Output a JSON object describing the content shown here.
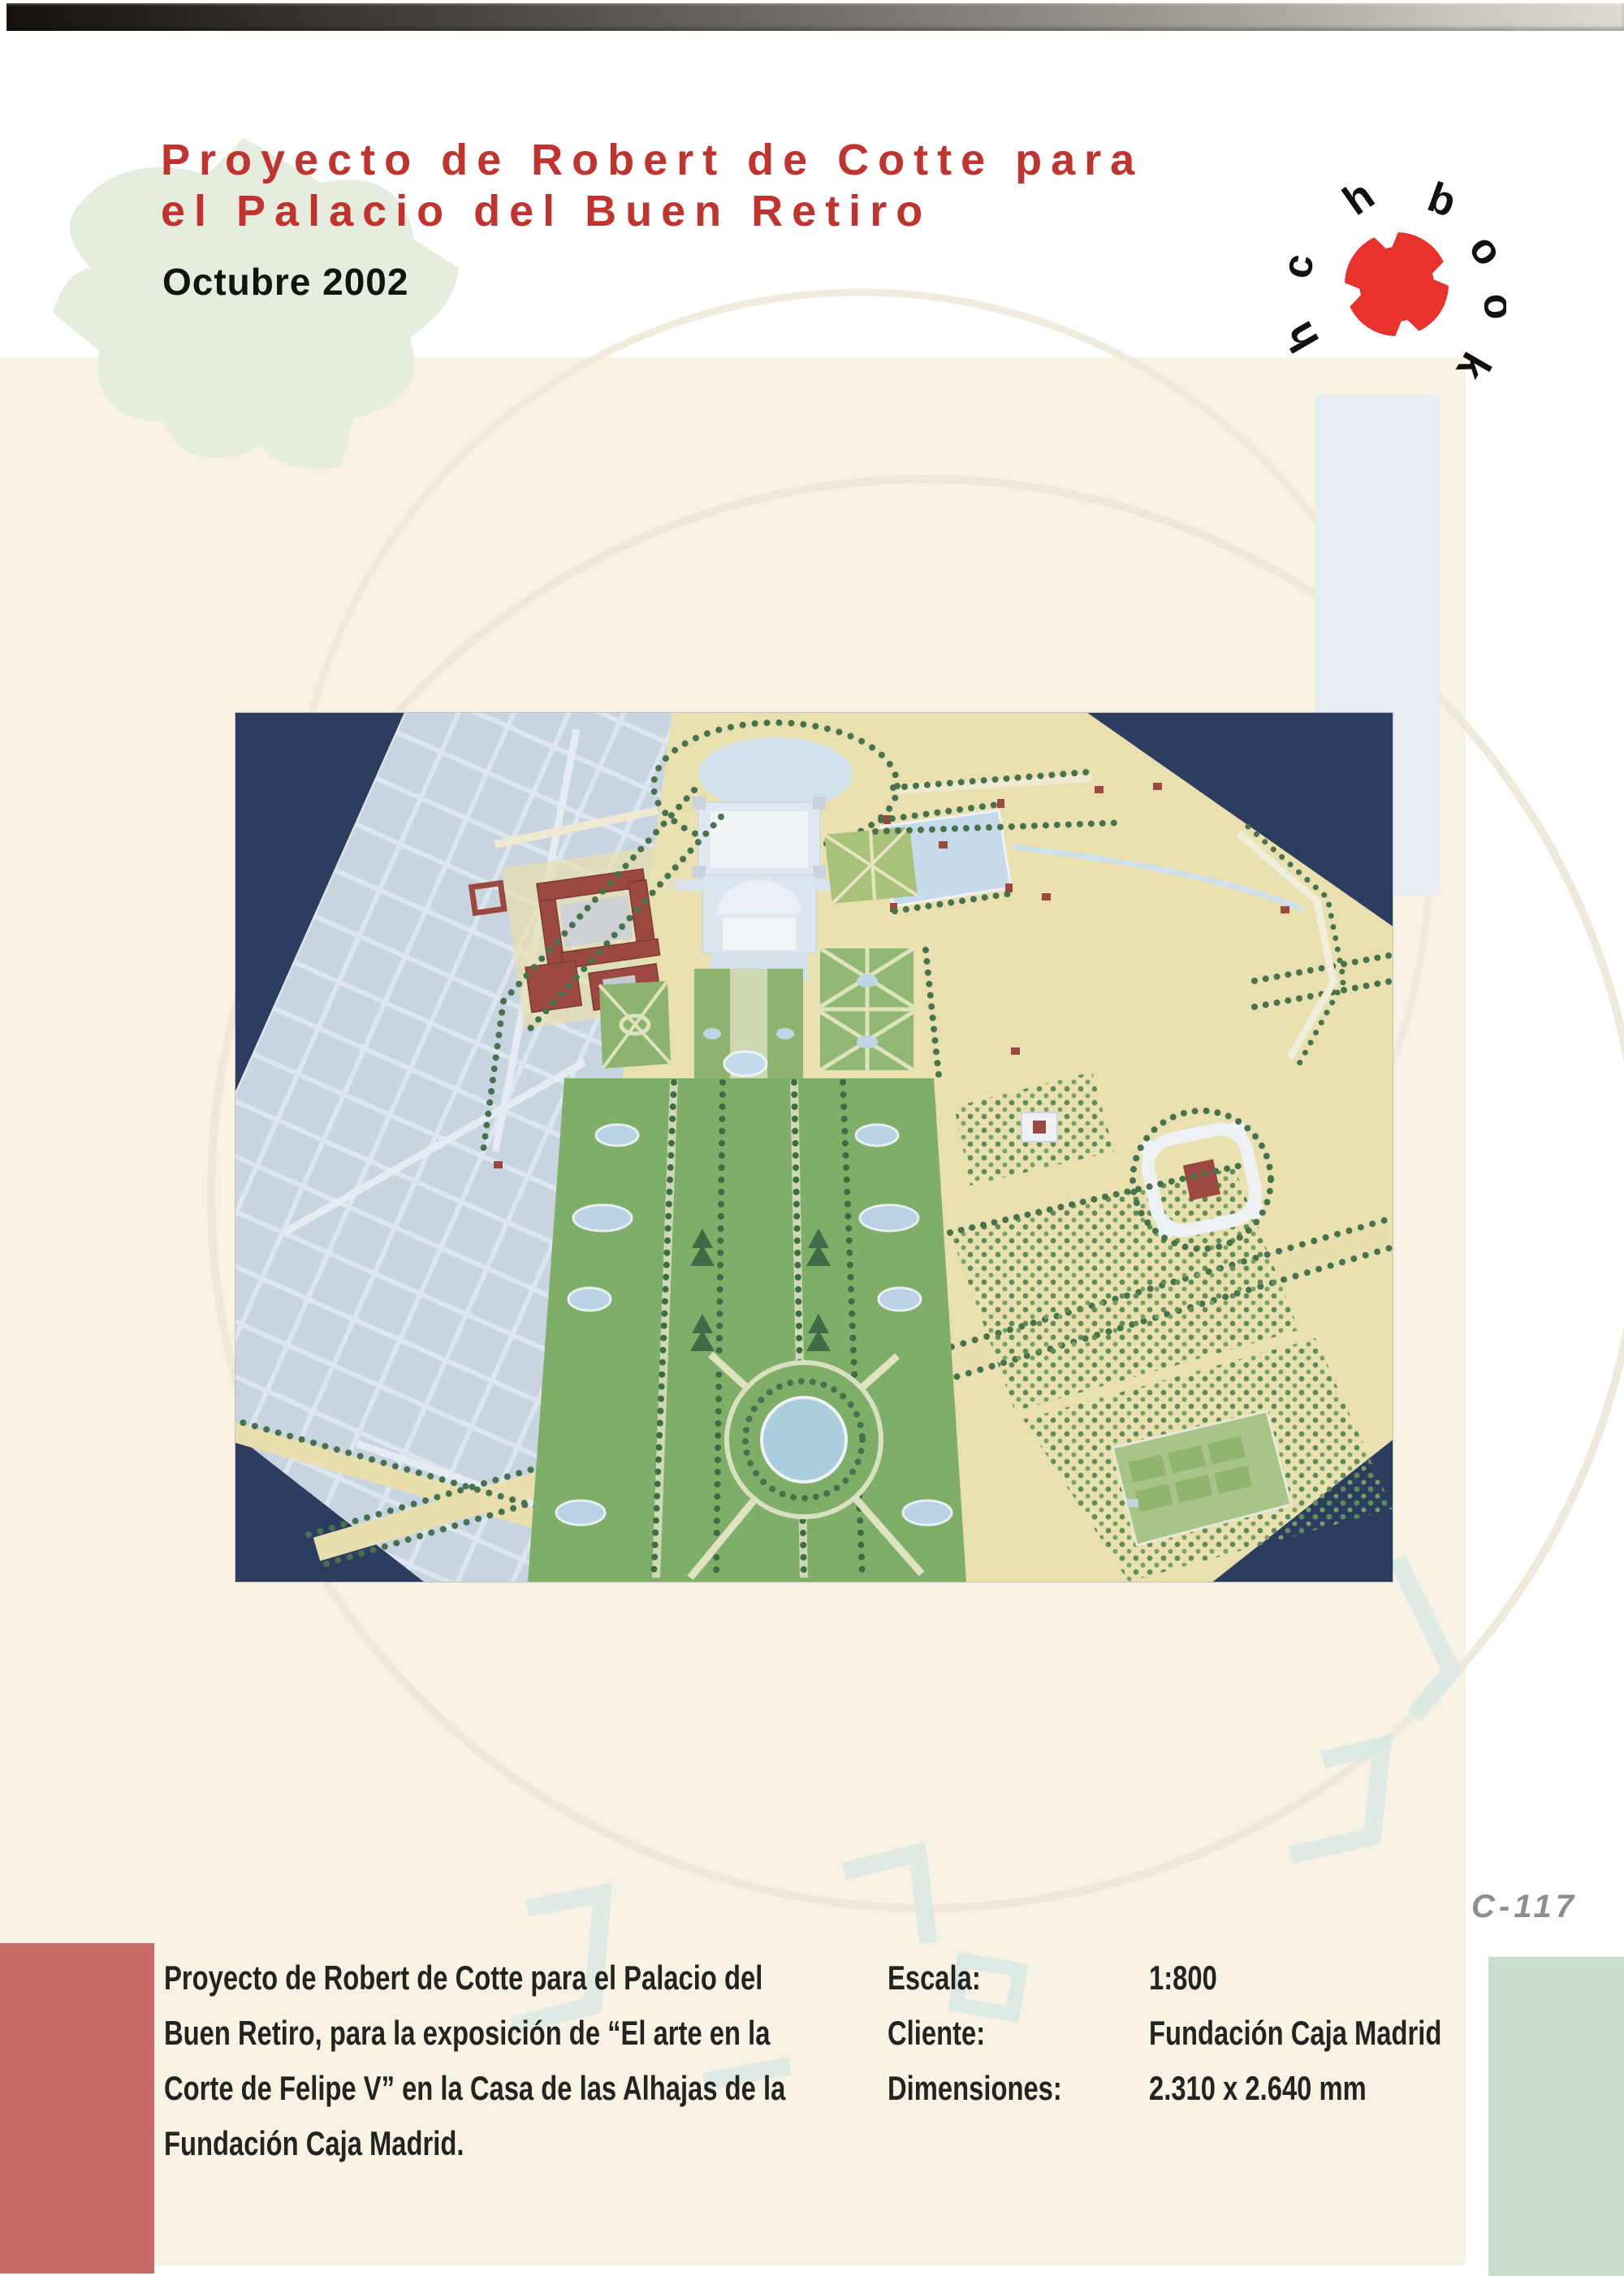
{
  "header": {
    "title_line1": "Proyecto de Robert de Cotte para",
    "title_line2": "el Palacio del Buen Retiro",
    "date": "Octubre 2002"
  },
  "logo": {
    "letters": [
      "h",
      "c",
      "h",
      "b",
      "o",
      "o",
      "k"
    ],
    "circle_color": "#e8322b"
  },
  "page_code": "C-117",
  "details": {
    "description_lines": [
      "Proyecto de Robert de Cotte  para el Palacio del",
      "Buen Retiro, para la exposición de “El arte en la",
      "Corte de Felipe V” en la Casa de las Alhajas de la",
      "Fundación Caja Madrid."
    ],
    "fields": [
      {
        "label": "Escala:",
        "value": "1:800"
      },
      {
        "label": "Cliente:",
        "value": "Fundación Caja Madrid"
      },
      {
        "label": "Dimensiones:",
        "value": "2.310 x 2.640 mm"
      }
    ]
  },
  "colors": {
    "accent_red": "#c0332e",
    "panel_cream": "#f8f2e5",
    "bar_blue": "#e7edf3",
    "block_red": "#c96b69",
    "block_green": "#c8ddcc",
    "code_gray": "#8e8e8c"
  }
}
